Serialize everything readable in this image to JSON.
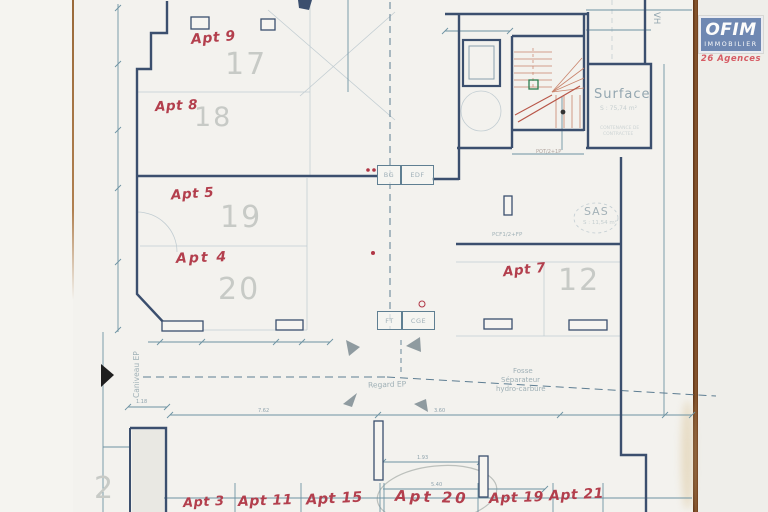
{
  "plan": {
    "handwritten_apartments": [
      {
        "text": "Apt 9"
      },
      {
        "text": "Apt 8"
      },
      {
        "text": "Apt 5"
      },
      {
        "text": "Apt 4"
      },
      {
        "text": "Apt 7"
      },
      {
        "text": "Apt 3"
      },
      {
        "text": "Apt 11"
      },
      {
        "text": "Apt 15"
      },
      {
        "text": "Apt 20"
      },
      {
        "text": "Apt 19"
      },
      {
        "text": "Apt 21"
      }
    ],
    "parking_numbers": [
      {
        "text": "17"
      },
      {
        "text": "18"
      },
      {
        "text": "19"
      },
      {
        "text": "20"
      },
      {
        "text": "12"
      },
      {
        "text": "2"
      }
    ],
    "rooms": {
      "surface_label": "Surface",
      "surface_area": "S : 75,74 m²",
      "surface_note_line1": "CONTENANCE DE",
      "surface_note_line2": "CONTRACTEE",
      "sas_label": "SAS",
      "sas_area": "S : 11,54 m²"
    },
    "utility_boxes": [
      {
        "label": "BG"
      },
      {
        "label": "EDF"
      },
      {
        "label": "FT"
      },
      {
        "label": "CGE"
      }
    ],
    "annotations": {
      "regard_ep": "Regard EP",
      "fosse_line1": "Fosse",
      "fosse_line2": "Séparateur",
      "fosse_line3": "hydro-carbure",
      "caniveau": "Caniveau EP",
      "vh": "VH",
      "pcf": "PCF1/2+FP",
      "pot": "POT/2+1P"
    },
    "dimensions": [
      {
        "text": "7.62"
      },
      {
        "text": "3.60"
      },
      {
        "text": "1.93"
      },
      {
        "text": "5.40"
      },
      {
        "text": "1.18"
      }
    ]
  },
  "logo": {
    "brand": "OFIM",
    "line2": "IMMOBILIER",
    "line3": "26 Agences"
  },
  "colors": {
    "wall_navy": "#3b4f6e",
    "thin_line_teal": "#6e93a3",
    "faint_line": "#c2cdd2",
    "handwriting_red": "#b03645",
    "parking_number_gray": "#c7cac6",
    "plan_text_gray": "#9fb0b6",
    "stair_red": "#c9836b",
    "scan_edge_brown": "#6e3c1c",
    "logo_blue": "#2f5496",
    "logo_red": "#cd2332",
    "paper": "#f3f2ee"
  }
}
